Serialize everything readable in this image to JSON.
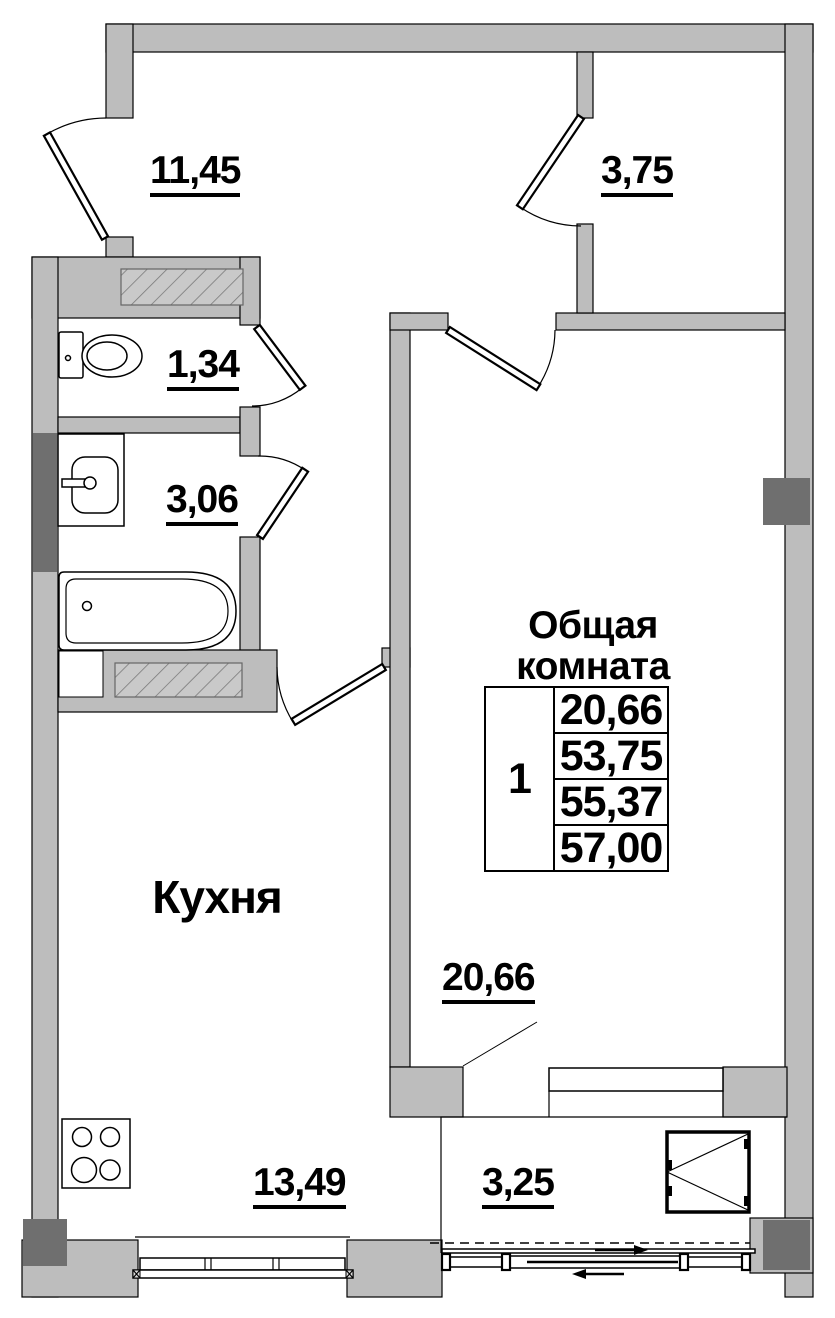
{
  "rooms": {
    "hallway": {
      "area": "11,45"
    },
    "storage": {
      "area": "3,75"
    },
    "wc": {
      "area": "1,34"
    },
    "bathroom": {
      "area": "3,06"
    },
    "living": {
      "name": "Общая комната",
      "area": "20,66"
    },
    "kitchen": {
      "name": "Кухня",
      "area": "13,49"
    },
    "balcony": {
      "area": "3,25"
    }
  },
  "summary": {
    "rooms_count": "1",
    "values": [
      "20,66",
      "53,75",
      "55,37",
      "57,00"
    ]
  },
  "fixtures": [
    "toilet-icon",
    "sink-icon",
    "bathtub-icon",
    "stove-icon",
    "vent-shaft-hatch",
    "casement-window-icon",
    "sliding-door-arrows"
  ],
  "colors": {
    "wall": "#bdbdbd",
    "pillar": "#6f6f6f",
    "hatch_bg": "#c9c9c9",
    "line": "#000000"
  }
}
